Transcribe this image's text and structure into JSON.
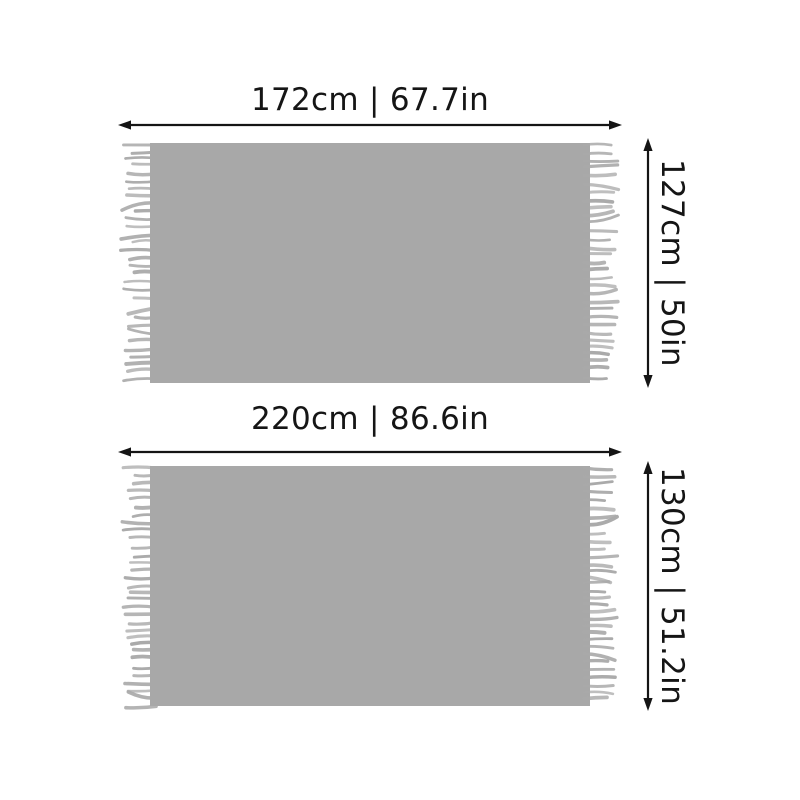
{
  "page": {
    "background": "#ffffff"
  },
  "colors": {
    "blanket_fill": "#a8a8a8",
    "fringe": "#a9a9a9",
    "arrow": "#151515",
    "label_text": "#151515"
  },
  "blankets": [
    {
      "width_label": "172cm | 67.7in",
      "height_label": "127cm | 50in",
      "width_cm": 172,
      "width_in": 67.7,
      "height_cm": 127,
      "height_in": 50
    },
    {
      "width_label": "220cm | 86.6in",
      "height_label": "130cm | 51.2in",
      "width_cm": 220,
      "width_in": 86.6,
      "height_cm": 130,
      "height_in": 51.2
    }
  ]
}
